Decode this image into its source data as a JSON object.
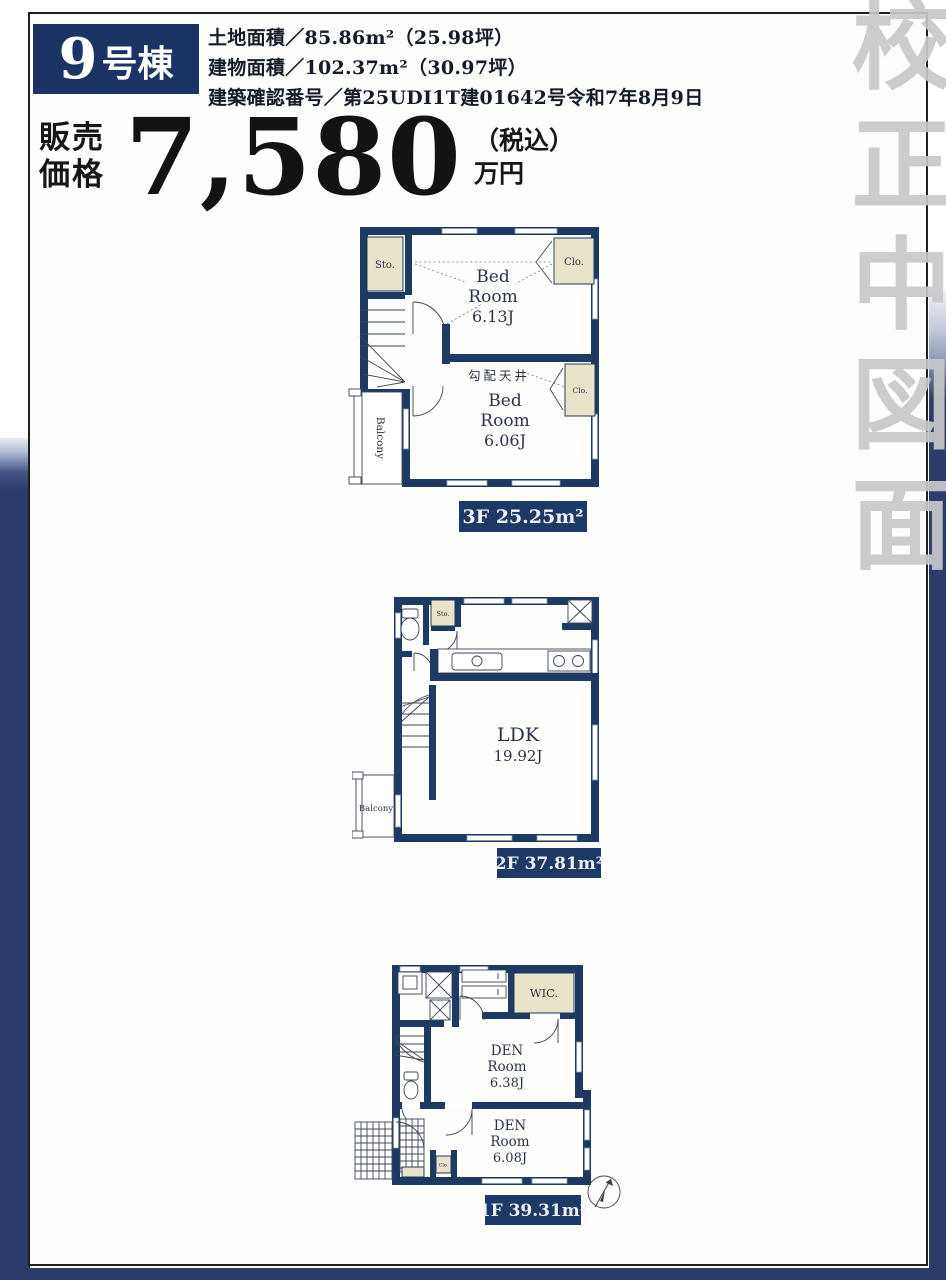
{
  "colors": {
    "wall_navy": "#1e3a63",
    "badge_navy": "#1c3366",
    "background_navy": "#2d3c6b",
    "closet_beige": "#e9e3ca",
    "watermark_gray": "#c8c8ca",
    "page_white": "#fdfdfc"
  },
  "header": {
    "unit_number": "9",
    "unit_suffix": "号棟",
    "details": [
      "土地面積／85.86m²（25.98坪）",
      "建物面積／102.37m²（30.97坪）",
      "建築確認番号／第25UDI1T建01642号令和7年8月9日"
    ]
  },
  "price": {
    "label_top": "販売",
    "label_bottom": "価格",
    "amount": "7,580",
    "tax_note": "（税込）",
    "unit": "万円"
  },
  "watermark": {
    "text": "校正中図面"
  },
  "floors": {
    "f3": {
      "area_label": "3F 25.25m²",
      "storage": "Sto.",
      "closet_top": "Clo.",
      "closet_mid": "Clo.",
      "bedroom1": [
        "Bed",
        "Room",
        "6.13J"
      ],
      "sloped_ceiling": "勾配天井",
      "bedroom2": [
        "Bed",
        "Room",
        "6.06J"
      ],
      "balcony": "Balcony"
    },
    "f2": {
      "area_label": "2F 37.81m²",
      "storage": "Sto.",
      "ldk": [
        "LDK",
        "19.92J"
      ],
      "balcony": "Balcony"
    },
    "f1": {
      "area_label": "1F 39.31m²",
      "wic": "WIC.",
      "den1": [
        "DEN",
        "Room",
        "6.38J"
      ],
      "den2": [
        "DEN",
        "Room",
        "6.08J"
      ],
      "closet": "Clo."
    }
  }
}
